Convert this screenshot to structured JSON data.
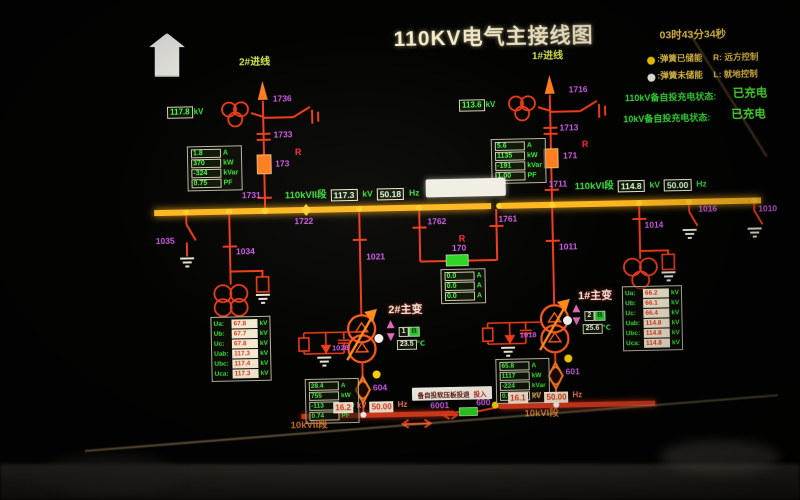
{
  "title": "110KV电气主接线图",
  "clock": "03时43分34秒",
  "legend": {
    "dot1_label": ":弹簧已储能",
    "r_label": "R: 远方控制",
    "dot2_label": ":弹簧未储能",
    "l_label": "L: 就地控制",
    "auto110_label": "110kV备自投充电状态:",
    "auto110_value": "已充电",
    "auto10_label": "10kV备自投充电状态:",
    "auto10_value": "已充电"
  },
  "bus110_2": {
    "name": "110kVII段",
    "kv": "117.3",
    "kv_unit": "kV",
    "hz": "50.18",
    "hz_unit": "Hz"
  },
  "bus110_1": {
    "name": "110kVI段",
    "kv": "114.8",
    "kv_unit": "kV",
    "hz": "50.00",
    "hz_unit": "Hz"
  },
  "bus10_2": {
    "name": "10kVII段",
    "kv": "16.2",
    "kv_unit": "kV",
    "hz": "50.00",
    "hz_unit": "Hz"
  },
  "bus10_1": {
    "name": "10kVI段",
    "kv": "16.1",
    "kv_unit": "kV",
    "hz": "50.00",
    "hz_unit": "Hz"
  },
  "feeder2": {
    "name": "2#进线",
    "pt_value": "117.8",
    "pt_unit": "kV",
    "r": "R",
    "sw_top": "1736",
    "sw_mid": "1733",
    "breaker": "173",
    "sw_bottom": "1731",
    "meas": [
      {
        "v": "1.8",
        "u": "A"
      },
      {
        "v": "370",
        "u": "kW"
      },
      {
        "v": "-324",
        "u": "kVar"
      },
      {
        "v": "0.75",
        "u": "PF"
      }
    ]
  },
  "feeder1": {
    "name": "1#进线",
    "pt_value": "113.6",
    "pt_unit": "kV",
    "r": "R",
    "sw_top": "1716",
    "sw_mid": "1713",
    "breaker": "171",
    "sw_bottom": "1711",
    "meas": [
      {
        "v": "5.6",
        "u": "A"
      },
      {
        "v": "1135",
        "u": "kW"
      },
      {
        "v": "-191",
        "u": "kVar"
      },
      {
        "v": "1.00",
        "u": "PF"
      }
    ]
  },
  "tie110": {
    "sw_left": "1762",
    "sw_right": "1761",
    "breaker": "170",
    "r": "R",
    "meas": [
      {
        "v": "0.0",
        "u": "A"
      },
      {
        "v": "0.0",
        "u": "A"
      },
      {
        "v": "0.0",
        "u": "A"
      }
    ]
  },
  "left_pt": {
    "node_sw": "1722",
    "earth_sw": "1035",
    "sw": "1034",
    "rows": [
      {
        "l": "Ua:",
        "v": "67.8",
        "u": "kV"
      },
      {
        "l": "Ub:",
        "v": "67.7",
        "u": "kV"
      },
      {
        "l": "Uc:",
        "v": "67.8",
        "u": "kV"
      },
      {
        "l": "Uab:",
        "v": "117.3",
        "u": "kV"
      },
      {
        "l": "Ubc:",
        "v": "117.4",
        "u": "kV"
      },
      {
        "l": "Uca:",
        "v": "117.3",
        "u": "kV"
      }
    ]
  },
  "right_pt": {
    "sw": "1014",
    "earth_sw": "1016",
    "end_sw": "1010",
    "rows": [
      {
        "l": "Ua:",
        "v": "66.2",
        "u": "kV"
      },
      {
        "l": "Ub:",
        "v": "66.1",
        "u": "kV"
      },
      {
        "l": "Uc:",
        "v": "66.4",
        "u": "kV"
      },
      {
        "l": "Uab:",
        "v": "114.8",
        "u": "kV"
      },
      {
        "l": "Ubc:",
        "v": "114.8",
        "u": "kV"
      },
      {
        "l": "Uca:",
        "v": "114.8",
        "u": "kV"
      }
    ]
  },
  "tx2": {
    "name": "2#主变",
    "hv_sw": "1021",
    "arrester_sw": "1028",
    "breaker": "604",
    "tap": "1",
    "tap_badge": "B",
    "temp": "23.5",
    "temp_unit": "℃",
    "meas": [
      {
        "v": "28.4",
        "u": "A"
      },
      {
        "v": "755",
        "u": "kW"
      },
      {
        "v": "-113",
        "u": "kVar"
      },
      {
        "v": "0.74",
        "u": "PF"
      }
    ]
  },
  "tx1": {
    "name": "1#主变",
    "hv_sw": "1011",
    "arrester_sw": "1018",
    "breaker": "601",
    "tap": "2",
    "tap_badge": "B",
    "temp": "25.6",
    "temp_unit": "℃",
    "meas": [
      {
        "v": "65.8",
        "u": "A"
      },
      {
        "v": "1117",
        "u": "kW"
      },
      {
        "v": "-224",
        "u": "kVar"
      },
      {
        "v": "0.98",
        "u": "PF"
      }
    ]
  },
  "tie10": {
    "sw": "6001",
    "breaker": "600",
    "note": "备自投软压板投退",
    "note_value": "投入"
  },
  "colors": {
    "bus_110kv": "#ffb71e",
    "line_energized": "#ee3c18",
    "bus_10kv": "#dd3c1e",
    "breaker_closed": "#ff7d1c",
    "breaker_open": "#2bd51f",
    "switch_label": "#cf5ce8",
    "value_green": "#52ff4a",
    "value_red": "#e2371c",
    "status_green": "#55ff38",
    "legend_yellow": "#ffd84d"
  }
}
